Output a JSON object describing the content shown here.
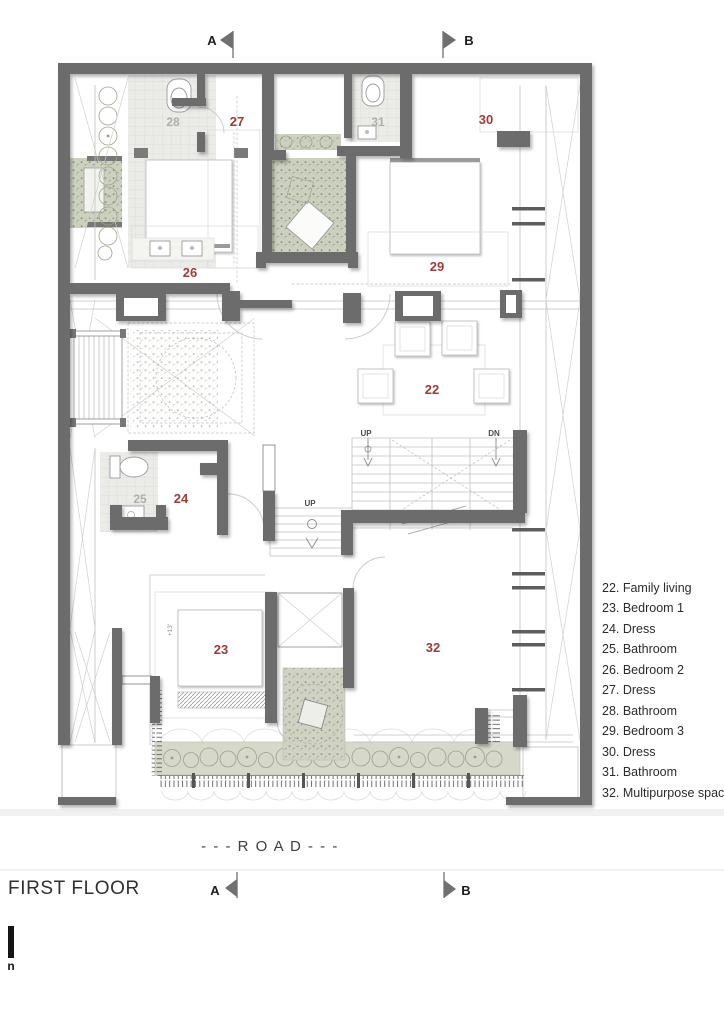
{
  "page": {
    "floor_label": "FIRST FLOOR",
    "road_label": "- - - R O A D - - -",
    "scale_glyph": "n"
  },
  "section_markers": {
    "top_a": "A",
    "top_b": "B",
    "bottom_a": "A",
    "bottom_b": "B"
  },
  "legend": {
    "items": [
      "22. Family living",
      "23. Bedroom 1",
      "24. Dress",
      "25. Bathroom",
      "26. Bedroom 2",
      "27. Dress",
      "28. Bathroom",
      "29. Bedroom 3",
      "30. Dress",
      "31. Bathroom",
      "32. Multipurpose space"
    ]
  },
  "plan_labels": {
    "family_living": "22",
    "bedroom1": "23",
    "dress24": "24",
    "bathroom25": "25",
    "bedroom2": "26",
    "dress27": "27",
    "bathroom28": "28",
    "bedroom3": "29",
    "dress30": "30",
    "bathroom31": "31",
    "multipurpose": "32",
    "up_main": "UP",
    "dn_main": "DN",
    "up_hall": "UP",
    "level_note": "+13'"
  },
  "colors": {
    "wall": "#6c6c6c",
    "label_red": "#9d3b3b",
    "label_gray": "#aeaeae",
    "plant_fill": "#ccd1bf",
    "terrace_fill": "#d6d8ca",
    "tile_fill": "#ebebe8"
  }
}
